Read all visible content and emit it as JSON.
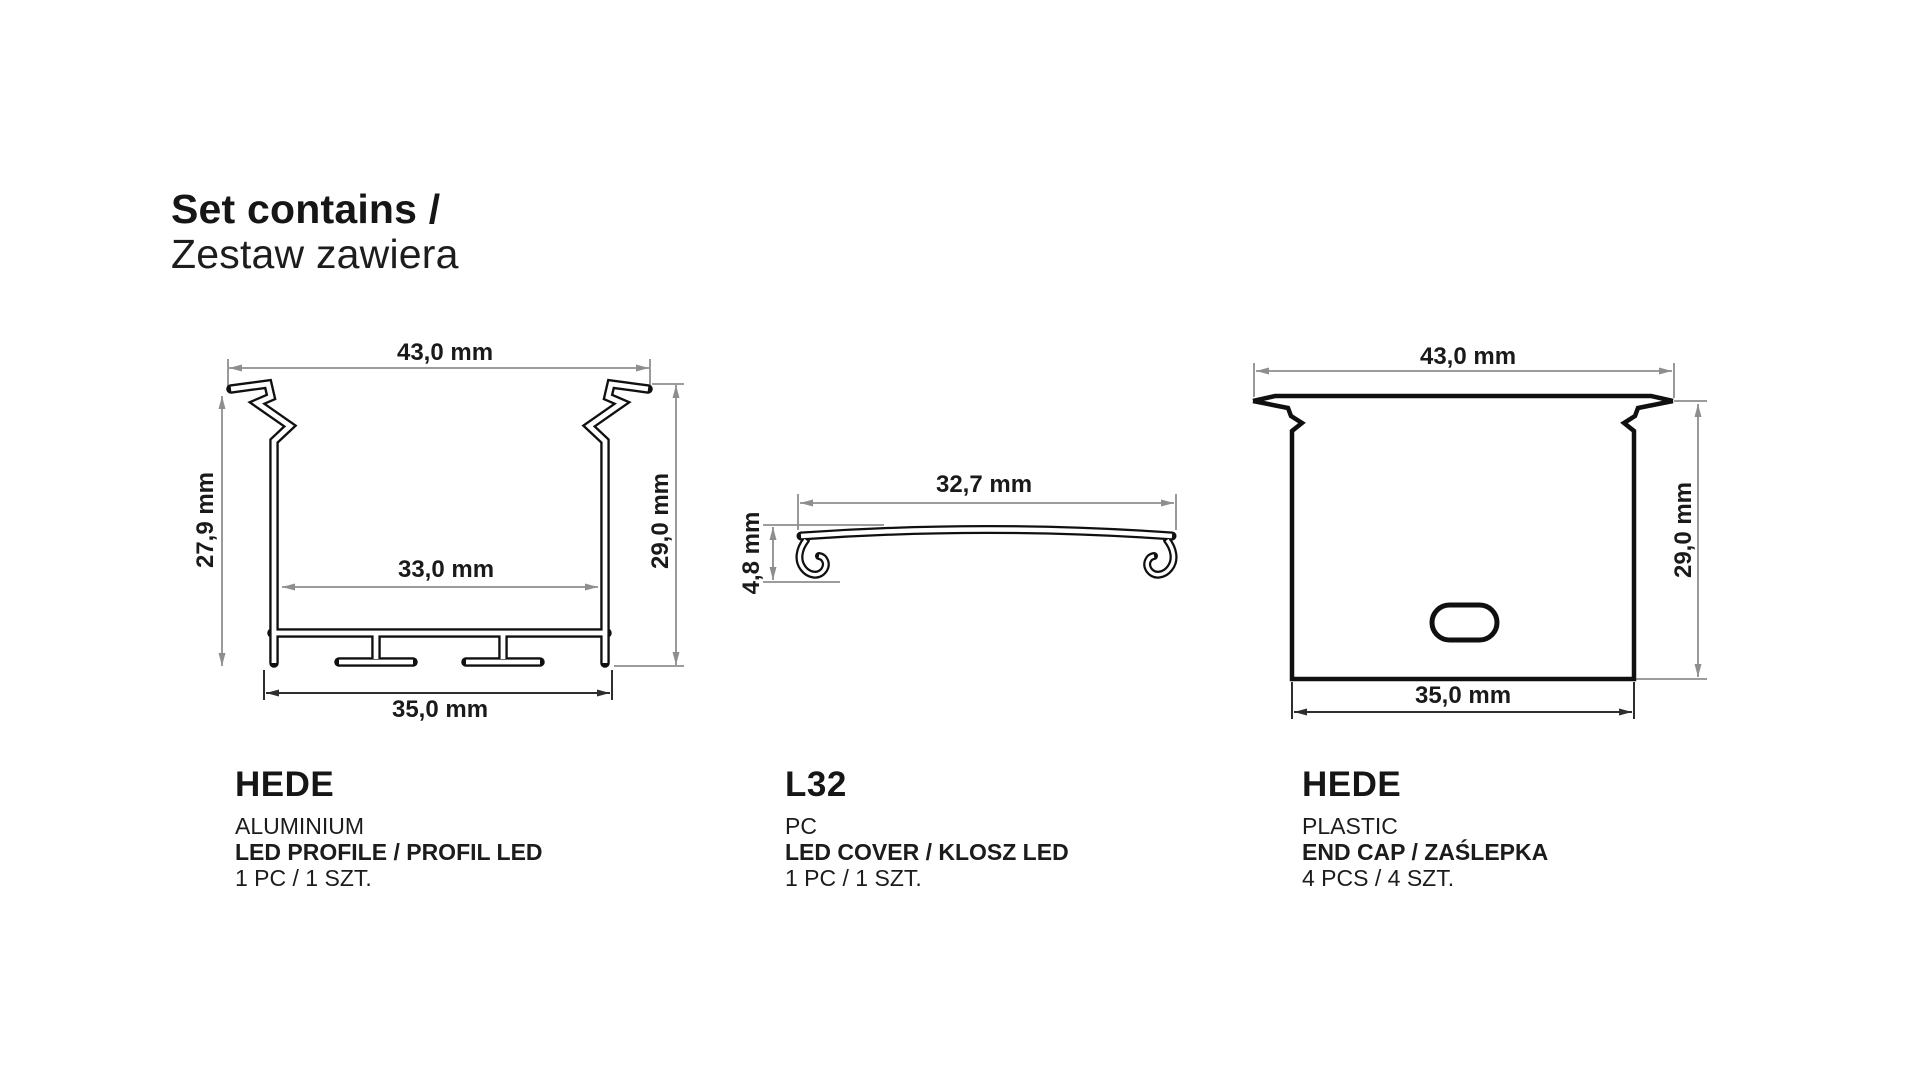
{
  "title": {
    "line1": "Set contains /",
    "line2": "Zestaw zawiera"
  },
  "colors": {
    "outline": "#101010",
    "dimension_line": "#8e8e8e",
    "dimension_dark": "#2e2e2e",
    "text": "#1a1a1a",
    "background": "#ffffff"
  },
  "figures": [
    {
      "name": "HEDE",
      "material": "ALUMINIUM",
      "type_label": "LED PROFILE / PROFIL LED",
      "quantity": "1 PC / 1 SZT.",
      "dims": {
        "top": "43,0 mm",
        "left": "27,9 mm",
        "inner": "33,0 mm",
        "right": "29,0 mm",
        "bottom": "35,0 mm"
      }
    },
    {
      "name": "L32",
      "material": "PC",
      "type_label": "LED COVER / KLOSZ LED",
      "quantity": "1 PC / 1 SZT.",
      "dims": {
        "top": "32,7 mm",
        "left": "4,8 mm"
      }
    },
    {
      "name": "HEDE",
      "material": "PLASTIC",
      "type_label": "END CAP / ZAŚLEPKA",
      "quantity": "4 PCS / 4 SZT.",
      "dims": {
        "top": "43,0 mm",
        "right": "29,0 mm",
        "bottom": "35,0 mm"
      }
    }
  ]
}
